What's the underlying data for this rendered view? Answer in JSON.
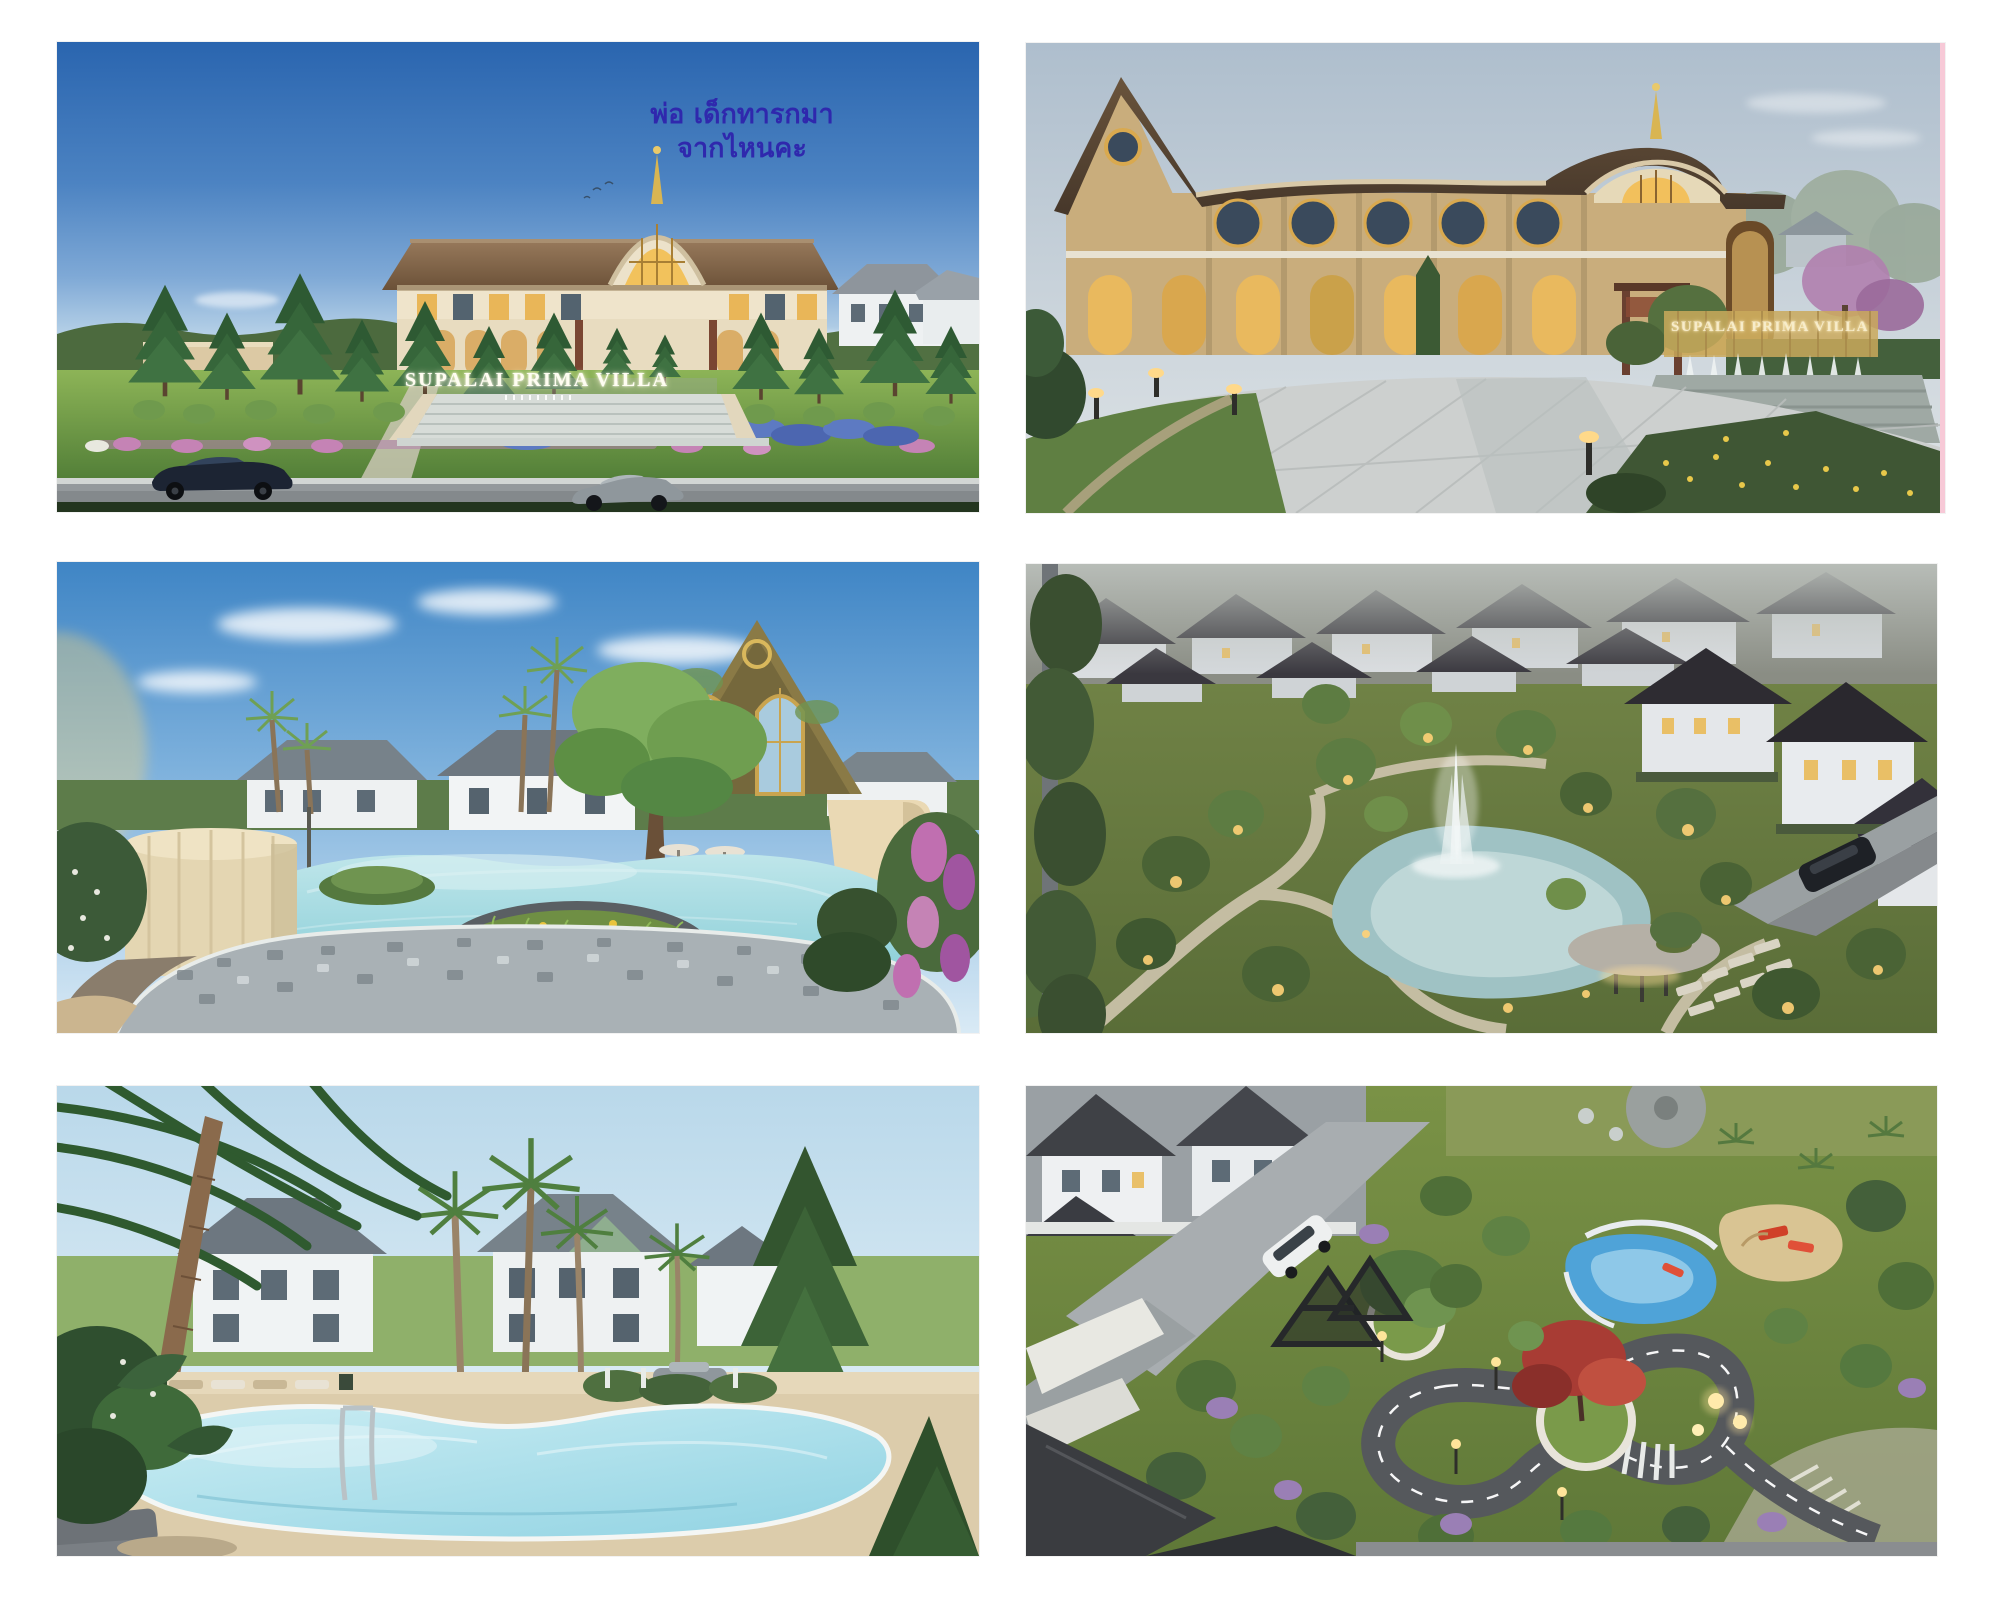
{
  "gallery": {
    "name": "supalai-prima-villa-render-collage",
    "items": [
      {
        "name": "entrance-day-render",
        "sign_text": "SUPALAI PRIMA VILLA",
        "annotation_line1": "พ่อ เด็กทารกมา",
        "annotation_line2": "จากไหนคะ"
      },
      {
        "name": "clubhouse-dusk-render",
        "sign_text": "SUPALAI PRIMA VILLA"
      },
      {
        "name": "lagoon-pool-render"
      },
      {
        "name": "lake-park-aerial-render"
      },
      {
        "name": "palm-pool-render"
      },
      {
        "name": "playground-track-aerial-render"
      }
    ],
    "colors": {
      "annotation_text": "#2f28ad",
      "sign_glow_white": "#fffdf2",
      "sign_gold": "#f7ecca",
      "day_sky_top": "#2a65af",
      "dusk_sky": "#b9c6d2",
      "pool_water": "#9fd9e4",
      "lawn_green": "#6f8f44",
      "photo_edge_pink": "#f7c9d7"
    }
  }
}
